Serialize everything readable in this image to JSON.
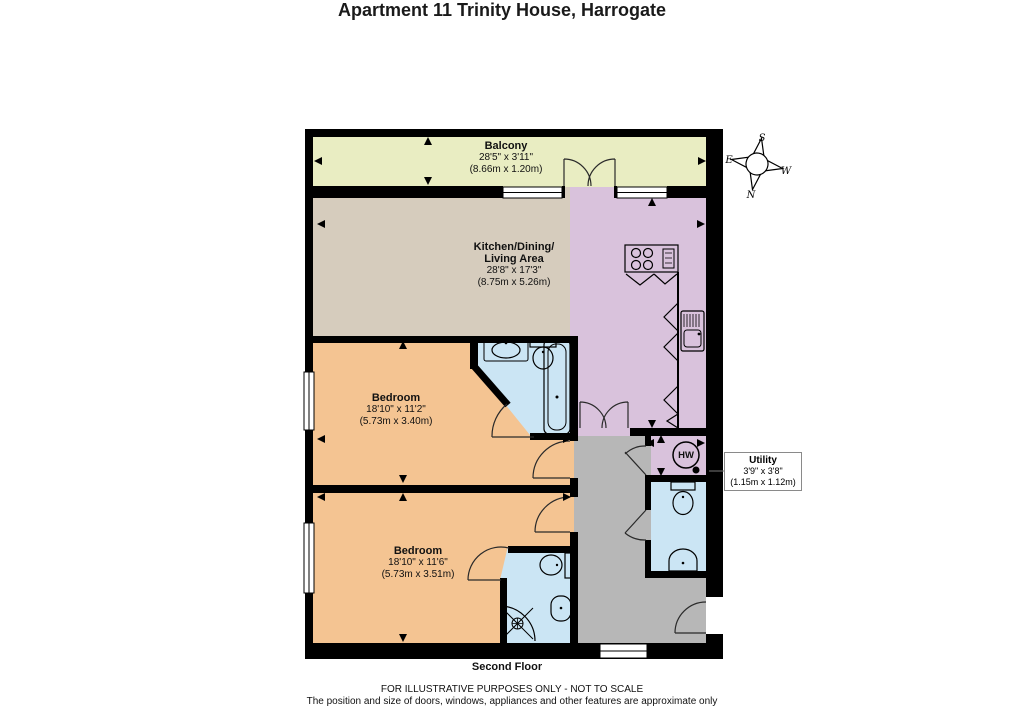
{
  "title": "Apartment 11 Trinity House, Harrogate",
  "floor_label": "Second Floor",
  "footer": {
    "line1": "FOR ILLUSTRATIVE PURPOSES ONLY - NOT TO SCALE",
    "line2": "The position and size of doors, windows, appliances and other features are approximate only"
  },
  "compass": {
    "north": "N",
    "south": "S",
    "east": "E",
    "west": "W"
  },
  "rooms": {
    "balcony": {
      "name": "Balcony",
      "size_imperial": "28'5\" x 3'11\"",
      "size_metric": "(8.66m x 1.20m)"
    },
    "kitchen": {
      "name_line1": "Kitchen/Dining/",
      "name_line2": "Living Area",
      "size_imperial": "28'8\" x 17'3\"",
      "size_metric": "(8.75m x 5.26m)"
    },
    "bedroom1": {
      "name": "Bedroom",
      "size_imperial": "18'10\" x 11'2\"",
      "size_metric": "(5.73m x 3.40m)"
    },
    "bedroom2": {
      "name": "Bedroom",
      "size_imperial": "18'10\" x 11'6\"",
      "size_metric": "(5.73m x 3.51m)"
    },
    "utility": {
      "name": "Utility",
      "size_imperial": "3'9\" x 3'8\"",
      "size_metric": "(1.15m x 1.12m)"
    },
    "hot_water_label": "HW"
  },
  "colors": {
    "wall": "#000000",
    "balcony": "#e9edc2",
    "living": "#d6ccbd",
    "kitchen": "#d9c2dc",
    "utility": "#d9c2dc",
    "bedroom": "#f4c492",
    "bathroom": "#cbe5f4",
    "hall": "#b7b7b7"
  }
}
